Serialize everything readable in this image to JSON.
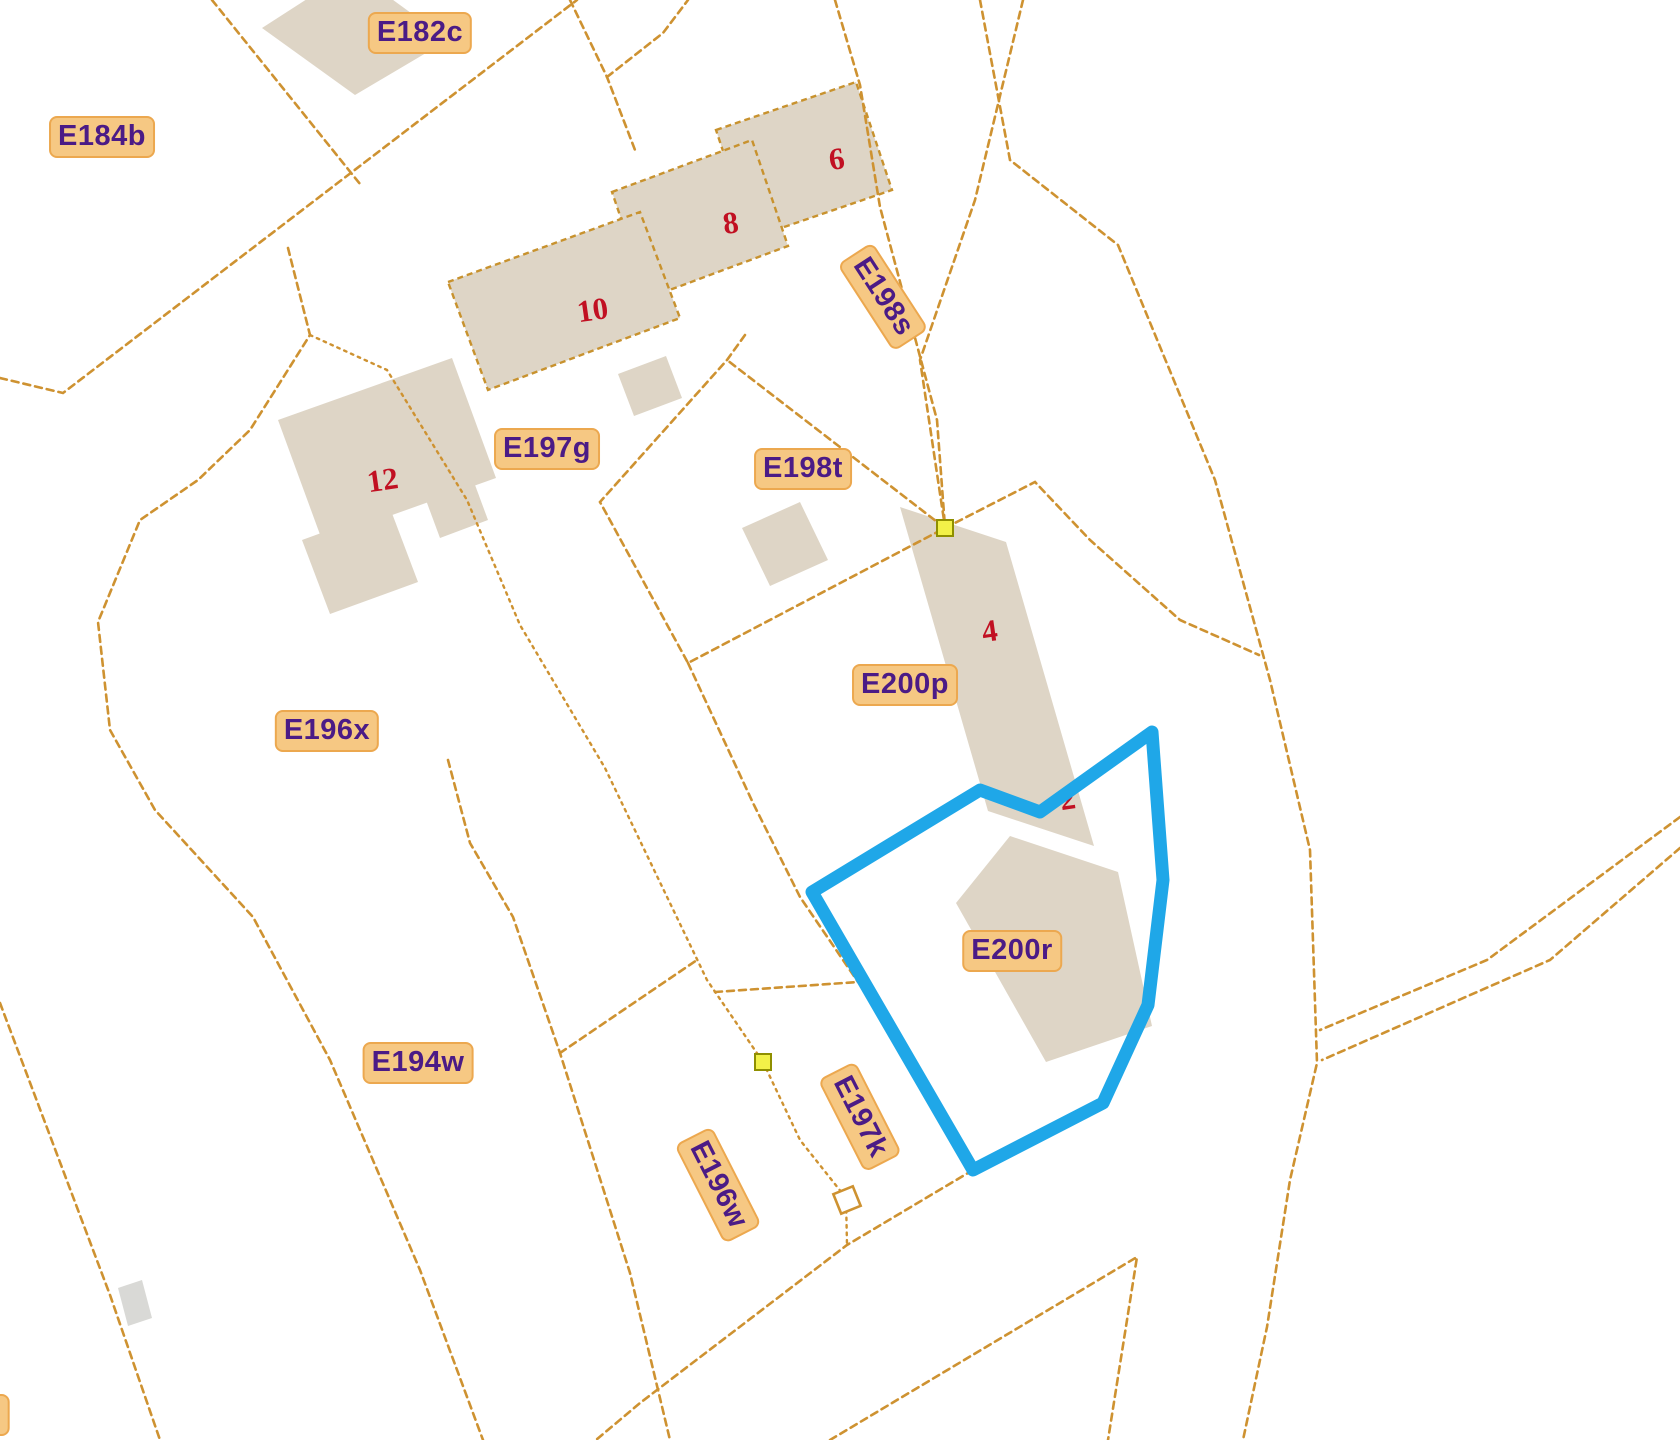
{
  "map": {
    "title": "cadastral parcel map",
    "colors": {
      "background": "#FFFFFF",
      "boundary_line": "#CE9231",
      "building_fill": "#DED5C6",
      "building_outline": "#C8922E",
      "grey_building_fill": "#D9D9D6",
      "label_bg": "#F6C883",
      "label_border": "#ECA84F",
      "label_text": "#4B1B86",
      "house_number": "#C11022",
      "highlight": "#1FA7E8",
      "vertex_fill": "#F2F148",
      "vertex_border": "#8F8F00",
      "small_square_fill": "#FFFFFF"
    },
    "parcel_labels": [
      {
        "text": "E182c",
        "x": 420,
        "y": 33,
        "rot": 0
      },
      {
        "text": "E184b",
        "x": 102,
        "y": 137,
        "rot": 0
      },
      {
        "text": "E197g",
        "x": 547,
        "y": 449,
        "rot": 0
      },
      {
        "text": "E198t",
        "x": 803,
        "y": 469,
        "rot": 0
      },
      {
        "text": "E198s",
        "x": 883,
        "y": 297,
        "rot": 57
      },
      {
        "text": "E196x",
        "x": 327,
        "y": 731,
        "rot": 0
      },
      {
        "text": "E200p",
        "x": 905,
        "y": 685,
        "rot": 0
      },
      {
        "text": "E200r",
        "x": 1012,
        "y": 951,
        "rot": 0
      },
      {
        "text": "E194w",
        "x": 418,
        "y": 1063,
        "rot": 0
      },
      {
        "text": "E196w",
        "x": 718,
        "y": 1185,
        "rot": 63
      },
      {
        "text": "E197k",
        "x": 860,
        "y": 1117,
        "rot": 63
      },
      {
        "text": "2",
        "x": -8,
        "y": 1415,
        "rot": 0
      }
    ],
    "house_numbers": [
      {
        "text": "6",
        "x": 837,
        "y": 162
      },
      {
        "text": "8",
        "x": 731,
        "y": 226
      },
      {
        "text": "10",
        "x": 593,
        "y": 313
      },
      {
        "text": "12",
        "x": 383,
        "y": 483
      },
      {
        "text": "4",
        "x": 990,
        "y": 634
      },
      {
        "text": "2",
        "x": 1068,
        "y": 802
      }
    ],
    "boundary_lines": [
      {
        "name": "road-west",
        "style": "dashed",
        "points": [
          [
            0,
            378
          ],
          [
            63,
            393
          ],
          [
            577,
            0
          ]
        ]
      },
      {
        "name": "divider-e184b-e182c",
        "style": "dashed",
        "points": [
          [
            212,
            0
          ],
          [
            360,
            184
          ]
        ]
      },
      {
        "name": "road-fork-a",
        "style": "dashed",
        "points": [
          [
            570,
            0
          ],
          [
            607,
            77
          ],
          [
            635,
            150
          ]
        ]
      },
      {
        "name": "road-fork-b",
        "style": "dashed",
        "points": [
          [
            607,
            77
          ],
          [
            663,
            33
          ],
          [
            688,
            0
          ]
        ]
      },
      {
        "name": "e198s-west",
        "style": "dashed",
        "points": [
          [
            835,
            0
          ],
          [
            860,
            85
          ],
          [
            880,
            207
          ],
          [
            937,
            420
          ],
          [
            945,
            527
          ]
        ]
      },
      {
        "name": "e198s-east",
        "style": "dashed",
        "points": [
          [
            1023,
            0
          ],
          [
            975,
            200
          ],
          [
            920,
            360
          ],
          [
            945,
            527
          ]
        ]
      },
      {
        "name": "road-east",
        "style": "dashed",
        "points": [
          [
            980,
            0
          ],
          [
            1010,
            160
          ],
          [
            1118,
            245
          ],
          [
            1215,
            480
          ],
          [
            1270,
            680
          ],
          [
            1310,
            850
          ],
          [
            1317,
            1063
          ],
          [
            1290,
            1180
          ],
          [
            1267,
            1327
          ],
          [
            1243,
            1440
          ]
        ]
      },
      {
        "name": "se-road-upper",
        "style": "dashed",
        "points": [
          [
            1680,
            817
          ],
          [
            1487,
            960
          ],
          [
            1320,
            1030
          ]
        ]
      },
      {
        "name": "se-road-lower",
        "style": "dashed",
        "points": [
          [
            1680,
            848
          ],
          [
            1550,
            960
          ],
          [
            1322,
            1060
          ]
        ]
      },
      {
        "name": "e198t-parcel",
        "style": "dashed",
        "points": [
          [
            745,
            335
          ],
          [
            727,
            360
          ],
          [
            600,
            502
          ],
          [
            688,
            663
          ],
          [
            945,
            528
          ],
          [
            727,
            360
          ]
        ]
      },
      {
        "name": "e200p-west",
        "style": "dashed",
        "points": [
          [
            688,
            663
          ],
          [
            753,
            803
          ],
          [
            800,
            897
          ],
          [
            858,
            982
          ]
        ]
      },
      {
        "name": "e200p-north",
        "style": "dashed",
        "points": [
          [
            945,
            528
          ],
          [
            1035,
            482
          ],
          [
            1090,
            540
          ],
          [
            1180,
            620
          ],
          [
            1259,
            655
          ]
        ]
      },
      {
        "name": "e196x-west-curve",
        "style": "dashed",
        "points": [
          [
            288,
            248
          ],
          [
            310,
            335
          ],
          [
            250,
            430
          ],
          [
            198,
            480
          ],
          [
            140,
            520
          ],
          [
            98,
            622
          ],
          [
            110,
            730
          ],
          [
            155,
            810
          ],
          [
            253,
            917
          ],
          [
            330,
            1060
          ],
          [
            420,
            1270
          ],
          [
            483,
            1440
          ]
        ]
      },
      {
        "name": "through-building-12",
        "style": "dotted",
        "points": [
          [
            310,
            335
          ],
          [
            387,
            370
          ],
          [
            467,
            500
          ],
          [
            520,
            625
          ],
          [
            605,
            768
          ],
          [
            707,
            980
          ],
          [
            763,
            1062
          ]
        ]
      },
      {
        "name": "e194w-e196w-divider",
        "style": "dashed",
        "points": [
          [
            448,
            760
          ],
          [
            470,
            843
          ],
          [
            513,
            917
          ],
          [
            560,
            1053
          ],
          [
            630,
            1273
          ],
          [
            670,
            1440
          ]
        ]
      },
      {
        "name": "e196w-top",
        "style": "dashed",
        "points": [
          [
            560,
            1053
          ],
          [
            697,
            960
          ]
        ]
      },
      {
        "name": "e197k-west-dotted",
        "style": "dotted",
        "points": [
          [
            763,
            1062
          ],
          [
            800,
            1140
          ],
          [
            846,
            1198
          ],
          [
            847,
            1245
          ]
        ]
      },
      {
        "name": "e197k-south",
        "style": "dashed",
        "points": [
          [
            973,
            1170
          ],
          [
            847,
            1245
          ],
          [
            640,
            1403
          ],
          [
            596,
            1440
          ]
        ]
      },
      {
        "name": "sw-boundary",
        "style": "dashed",
        "points": [
          [
            0,
            1003
          ],
          [
            110,
            1295
          ],
          [
            160,
            1440
          ]
        ]
      },
      {
        "name": "south-wedge",
        "style": "dashed",
        "points": [
          [
            830,
            1440
          ],
          [
            1137,
            1257
          ],
          [
            1108,
            1440
          ]
        ]
      },
      {
        "name": "short-connector",
        "style": "dashed",
        "points": [
          [
            715,
            992
          ],
          [
            858,
            982
          ]
        ]
      }
    ],
    "buildings": [
      {
        "name": "building-e182c",
        "fill": "beige",
        "outlined": false,
        "points": [
          [
            262,
            28
          ],
          [
            352,
            -30
          ],
          [
            448,
            40
          ],
          [
            355,
            95
          ]
        ]
      },
      {
        "name": "building-6",
        "fill": "beige",
        "outlined": true,
        "points": [
          [
            716,
            130
          ],
          [
            856,
            82
          ],
          [
            892,
            190
          ],
          [
            752,
            238
          ]
        ]
      },
      {
        "name": "building-8",
        "fill": "beige",
        "outlined": true,
        "points": [
          [
            612,
            192
          ],
          [
            752,
            140
          ],
          [
            788,
            246
          ],
          [
            648,
            298
          ]
        ]
      },
      {
        "name": "building-10",
        "fill": "beige",
        "outlined": true,
        "points": [
          [
            448,
            282
          ],
          [
            640,
            212
          ],
          [
            680,
            318
          ],
          [
            488,
            390
          ]
        ]
      },
      {
        "name": "building-10-annex",
        "fill": "beige",
        "outlined": false,
        "points": [
          [
            618,
            374
          ],
          [
            666,
            356
          ],
          [
            682,
            398
          ],
          [
            634,
            416
          ]
        ]
      },
      {
        "name": "building-12",
        "fill": "beige",
        "outlined": false,
        "points": [
          [
            278,
            420
          ],
          [
            452,
            358
          ],
          [
            496,
            478
          ],
          [
            322,
            540
          ]
        ]
      },
      {
        "name": "building-12-annex-a",
        "fill": "beige",
        "outlined": false,
        "points": [
          [
            302,
            540
          ],
          [
            390,
            508
          ],
          [
            418,
            582
          ],
          [
            330,
            614
          ]
        ]
      },
      {
        "name": "building-12-annex-b",
        "fill": "beige",
        "outlined": false,
        "points": [
          [
            420,
            484
          ],
          [
            468,
            466
          ],
          [
            488,
            520
          ],
          [
            440,
            538
          ]
        ]
      },
      {
        "name": "building-e198t",
        "fill": "beige",
        "outlined": false,
        "points": [
          [
            742,
            528
          ],
          [
            800,
            502
          ],
          [
            828,
            560
          ],
          [
            770,
            586
          ]
        ]
      },
      {
        "name": "building-4",
        "fill": "beige",
        "outlined": false,
        "points": [
          [
            900,
            507
          ],
          [
            1006,
            542
          ],
          [
            1094,
            846
          ],
          [
            988,
            811
          ]
        ]
      },
      {
        "name": "building-e200r",
        "fill": "beige",
        "outlined": false,
        "points": [
          [
            956,
            903
          ],
          [
            1010,
            836
          ],
          [
            1118,
            872
          ],
          [
            1152,
            1026
          ],
          [
            1046,
            1062
          ]
        ]
      },
      {
        "name": "building-grey-small",
        "fill": "grey",
        "outlined": false,
        "points": [
          [
            118,
            1288
          ],
          [
            142,
            1280
          ],
          [
            152,
            1318
          ],
          [
            128,
            1326
          ]
        ]
      }
    ],
    "highlight_parcel": {
      "name": "E200r selection outline",
      "stroke_width": 13,
      "points": [
        [
          812,
          892
        ],
        [
          980,
          790
        ],
        [
          1040,
          812
        ],
        [
          1152,
          732
        ],
        [
          1163,
          880
        ],
        [
          1148,
          1005
        ],
        [
          1103,
          1103
        ],
        [
          973,
          1170
        ]
      ]
    },
    "vertex_markers": [
      {
        "x": 945,
        "y": 528,
        "size": 16
      },
      {
        "x": 763,
        "y": 1062,
        "size": 16
      }
    ],
    "square_marker": {
      "x": 847,
      "y": 1200,
      "size": 21,
      "rot": -22
    }
  }
}
